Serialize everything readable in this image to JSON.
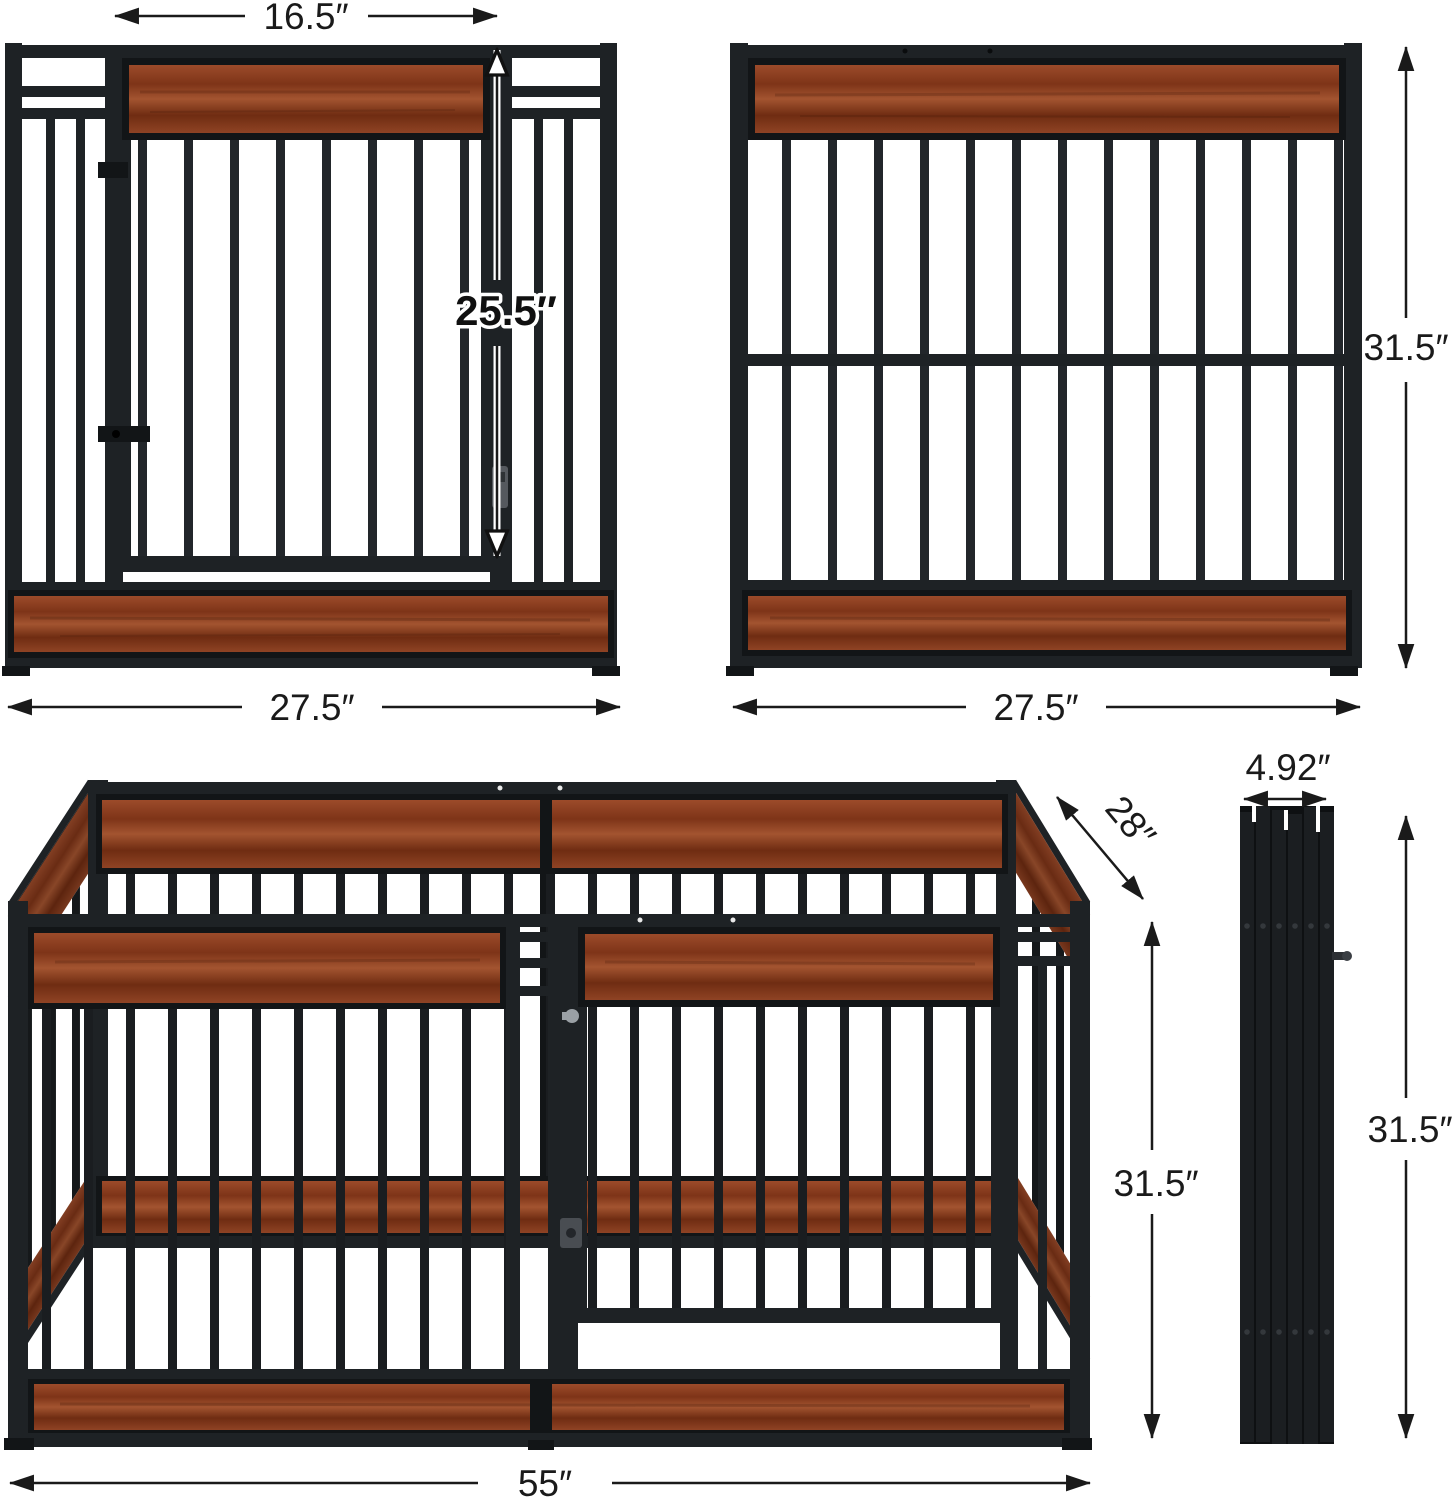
{
  "canvas": {
    "width": 1454,
    "height": 1500,
    "background": "#ffffff"
  },
  "palette": {
    "metal_frame": "#1e2225",
    "metal_deep": "#121517",
    "wood_brown": "#8e4126",
    "wood_dark": "#6f2c12",
    "dimension_ink": "#1a1a1a",
    "halo_white": "#ffffff",
    "latch_gray": "#9aa0a5"
  },
  "dims": {
    "door_width": {
      "label": "16.5″",
      "orientation": "horizontal"
    },
    "door_height": {
      "label": "25.5″",
      "orientation": "vertical"
    },
    "left_panel_width": {
      "label": "27.5″",
      "orientation": "horizontal"
    },
    "right_panel_width": {
      "label": "27.5″",
      "orientation": "horizontal"
    },
    "panel_height": {
      "label": "31.5″",
      "orientation": "vertical"
    },
    "pen_depth": {
      "label": "28″",
      "orientation": "diagonal"
    },
    "folded_width": {
      "label": "4.92″",
      "orientation": "horizontal"
    },
    "pen_height": {
      "label": "31.5″",
      "orientation": "vertical"
    },
    "folded_height": {
      "label": "31.5″",
      "orientation": "vertical"
    },
    "pen_width": {
      "label": "55″",
      "orientation": "horizontal"
    }
  }
}
